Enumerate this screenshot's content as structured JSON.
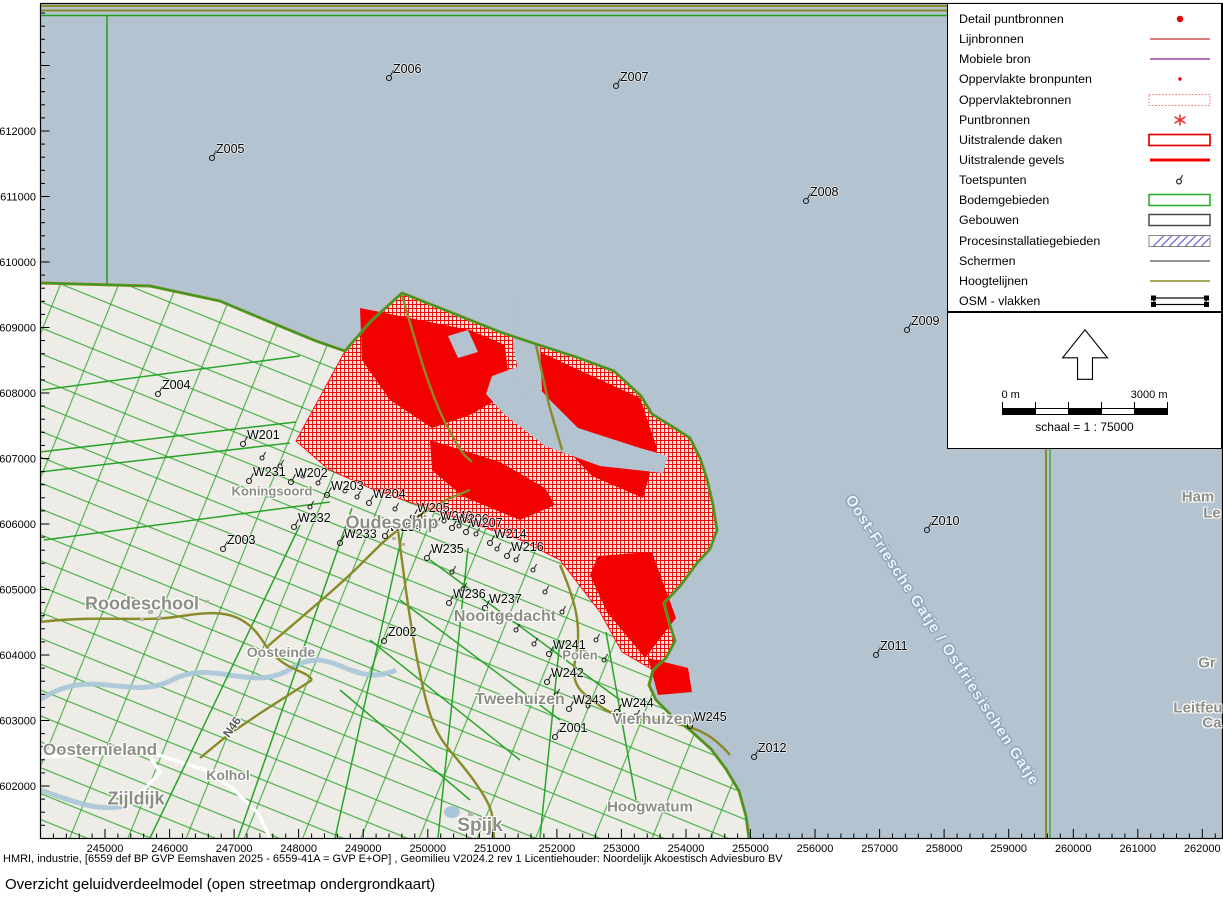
{
  "legend": {
    "items": [
      {
        "label": "Detail puntbronnen",
        "symbol": "dot-red"
      },
      {
        "label": "Lijnbronnen",
        "symbol": "line-red"
      },
      {
        "label": "Mobiele bron",
        "symbol": "line-purple"
      },
      {
        "label": "Oppervlakte bronpunten",
        "symbol": "dot-red-small"
      },
      {
        "label": "Oppervlaktebronnen",
        "symbol": "rect-dotted-red"
      },
      {
        "label": "Puntbronnen",
        "symbol": "asterisk-red"
      },
      {
        "label": "Uitstralende daken",
        "symbol": "rect-red"
      },
      {
        "label": "Uitstralende gevels",
        "symbol": "line-red-thick"
      },
      {
        "label": "Toetspunten",
        "symbol": "toetspunt"
      },
      {
        "label": "Bodemgebieden",
        "symbol": "rect-green"
      },
      {
        "label": "Gebouwen",
        "symbol": "rect-gray"
      },
      {
        "label": "Procesinstallatiegebieden",
        "symbol": "rect-hatched-blue"
      },
      {
        "label": "Schermen",
        "symbol": "line-gray"
      },
      {
        "label": "Hoogtelijnen",
        "symbol": "line-olive"
      },
      {
        "label": "OSM - vlakken",
        "symbol": "rect-osm"
      }
    ]
  },
  "compass_scale": {
    "scale_left": "0 m",
    "scale_right": "3000 m",
    "scale_caption": "schaal = 1 : 75000"
  },
  "axes": {
    "x_labels": [
      "245000",
      "246000",
      "247000",
      "248000",
      "249000",
      "250000",
      "251000",
      "252000",
      "253000",
      "254000",
      "255000",
      "256000",
      "257000",
      "258000",
      "259000",
      "260000",
      "261000",
      "262000"
    ],
    "y_labels": [
      "612000",
      "611000",
      "610000",
      "609000",
      "608000",
      "607000",
      "606000",
      "605000",
      "604000",
      "603000",
      "602000"
    ]
  },
  "map": {
    "points": [
      {
        "label": "Z001",
        "x": 555,
        "y": 737
      },
      {
        "label": "Z002",
        "x": 384,
        "y": 641
      },
      {
        "label": "Z003",
        "x": 223,
        "y": 549
      },
      {
        "label": "Z004",
        "x": 158,
        "y": 394
      },
      {
        "label": "Z005",
        "x": 212,
        "y": 158
      },
      {
        "label": "Z006",
        "x": 389,
        "y": 78
      },
      {
        "label": "Z007",
        "x": 616,
        "y": 86
      },
      {
        "label": "Z008",
        "x": 806,
        "y": 201
      },
      {
        "label": "Z009",
        "x": 907,
        "y": 330
      },
      {
        "label": "Z010",
        "x": 927,
        "y": 530
      },
      {
        "label": "Z011",
        "x": 876,
        "y": 655
      },
      {
        "label": "Z012",
        "x": 754,
        "y": 757
      },
      {
        "label": "W201",
        "x": 243,
        "y": 444
      },
      {
        "label": "W231",
        "x": 249,
        "y": 481
      },
      {
        "label": "W202",
        "x": 291,
        "y": 482
      },
      {
        "label": "W203",
        "x": 327,
        "y": 495
      },
      {
        "label": "W204",
        "x": 369,
        "y": 503
      },
      {
        "label": "W232",
        "x": 294,
        "y": 527
      },
      {
        "label": "W233",
        "x": 340,
        "y": 543
      },
      {
        "label": "W234",
        "x": 385,
        "y": 536
      },
      {
        "label": "W205",
        "x": 413,
        "y": 517
      },
      {
        "label": "W240",
        "x": 436,
        "y": 525
      },
      {
        "label": "W206",
        "x": 452,
        "y": 528
      },
      {
        "label": "W207",
        "x": 466,
        "y": 532
      },
      {
        "label": "W214",
        "x": 490,
        "y": 543
      },
      {
        "label": "W216",
        "x": 507,
        "y": 556
      },
      {
        "label": "W235",
        "x": 427,
        "y": 558
      },
      {
        "label": "W236",
        "x": 449,
        "y": 603
      },
      {
        "label": "W237",
        "x": 485,
        "y": 608
      },
      {
        "label": "W241",
        "x": 549,
        "y": 654
      },
      {
        "label": "W242",
        "x": 547,
        "y": 682
      },
      {
        "label": "W243",
        "x": 569,
        "y": 709
      },
      {
        "label": "W244",
        "x": 617,
        "y": 712
      },
      {
        "label": "W245",
        "x": 690,
        "y": 726
      }
    ],
    "extra_markers": [
      [
        262,
        458
      ],
      [
        280,
        466
      ],
      [
        303,
        476
      ],
      [
        318,
        483
      ],
      [
        345,
        491
      ],
      [
        357,
        497
      ],
      [
        395,
        509
      ],
      [
        420,
        517
      ],
      [
        444,
        521
      ],
      [
        459,
        526
      ],
      [
        476,
        534
      ],
      [
        497,
        549
      ],
      [
        516,
        560
      ],
      [
        533,
        570
      ],
      [
        452,
        572
      ],
      [
        463,
        589
      ],
      [
        500,
        618
      ],
      [
        516,
        630
      ],
      [
        534,
        644
      ],
      [
        556,
        695
      ],
      [
        588,
        706
      ],
      [
        636,
        716
      ],
      [
        660,
        721
      ],
      [
        352,
        531
      ],
      [
        310,
        507
      ],
      [
        545,
        592
      ],
      [
        562,
        612
      ],
      [
        596,
        640
      ],
      [
        604,
        660
      ]
    ],
    "places": [
      {
        "name": "Roodeschool",
        "x": 142,
        "y": 604,
        "size": 18
      },
      {
        "name": "Oudeschip",
        "x": 392,
        "y": 523,
        "size": 18
      },
      {
        "name": "Nooitgedacht",
        "x": 505,
        "y": 617,
        "size": 16
      },
      {
        "name": "Tweehuizen",
        "x": 520,
        "y": 700,
        "size": 16
      },
      {
        "name": "Vierhuizen",
        "x": 652,
        "y": 720,
        "size": 16
      },
      {
        "name": "Hoogwatum",
        "x": 650,
        "y": 807,
        "size": 15
      },
      {
        "name": "Oosternieland",
        "x": 100,
        "y": 750,
        "size": 17
      },
      {
        "name": "Zijldijk",
        "x": 136,
        "y": 799,
        "size": 18
      },
      {
        "name": "Kolhol",
        "x": 228,
        "y": 775,
        "size": 14
      },
      {
        "name": "Oosteinde",
        "x": 281,
        "y": 652,
        "size": 14
      },
      {
        "name": "Koningsoord",
        "x": 272,
        "y": 491,
        "size": 13
      },
      {
        "name": "Polen",
        "x": 580,
        "y": 655,
        "size": 13
      },
      {
        "name": "Spijk",
        "x": 480,
        "y": 826,
        "size": 19
      },
      {
        "name": "Ham",
        "x": 1198,
        "y": 497,
        "size": 15
      },
      {
        "name": "Le",
        "x": 1212,
        "y": 513,
        "size": 15
      },
      {
        "name": "Gr",
        "x": 1207,
        "y": 663,
        "size": 15
      },
      {
        "name": "Leitfeu",
        "x": 1198,
        "y": 708,
        "size": 15
      },
      {
        "name": "Ca",
        "x": 1212,
        "y": 723,
        "size": 15
      },
      {
        "name": "N46",
        "x": 232,
        "y": 727,
        "size": 12,
        "rotate": -55,
        "color": "#5a5a55"
      }
    ],
    "water_label": {
      "text": "Oost-Friesche Gatje / Ostfriesischen Gatje"
    },
    "colors": {
      "water": "#b3c3cf",
      "land": "#edece6",
      "source_red": "#f40000",
      "boundary_green": "#1fa11f",
      "road_olive": "#8a8a28",
      "mobile_purple": "#b05ab0"
    }
  },
  "footer": {
    "attribution": "HMRI, industrie, [6559 def BP GVP Eemshaven 2025 - 6559-41A = GVP E+OP] , Geomilieu V2024.2 rev 1 Licentiehouder: Noordelijk Akoestisch Adviesburo BV",
    "map_title": "Overzicht geluidverdeelmodel (open streetmap ondergrondkaart)"
  }
}
